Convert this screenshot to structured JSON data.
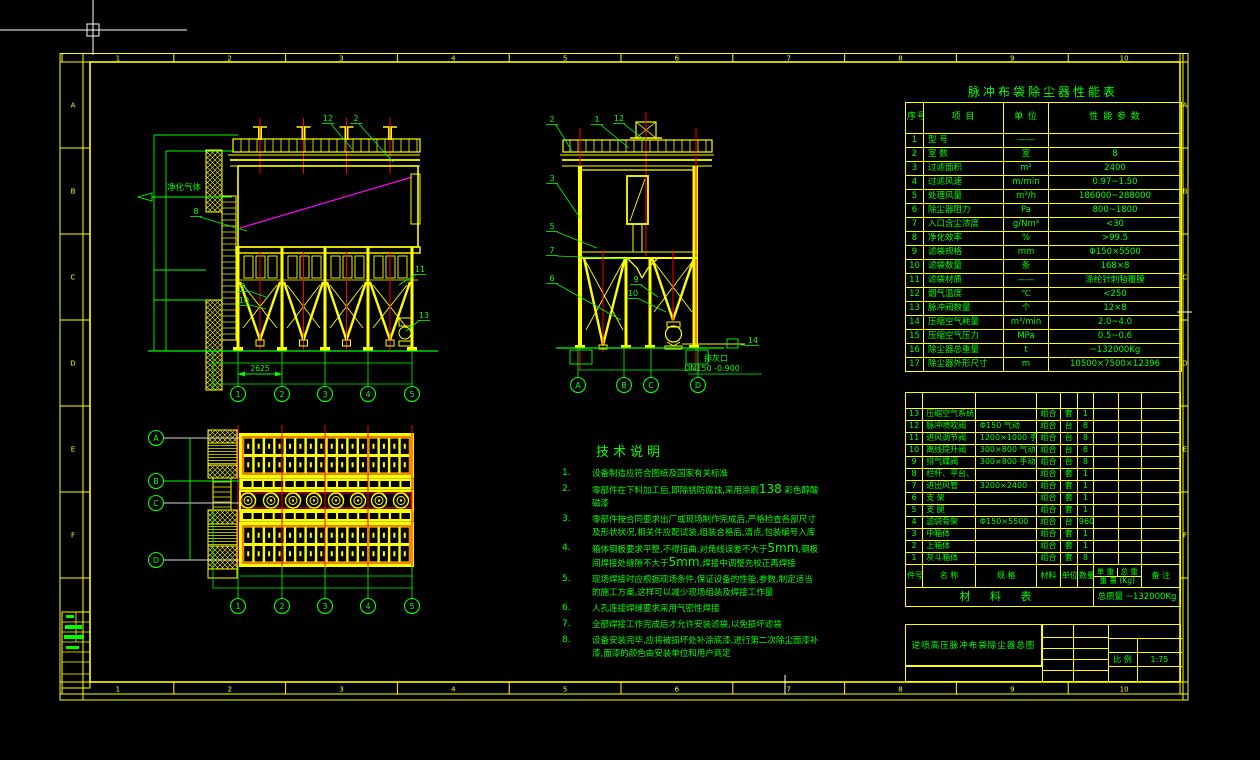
{
  "cursor": {
    "type": "crosshair"
  },
  "sheet": {
    "zone_numbers": [
      "1",
      "2",
      "3",
      "4",
      "5",
      "6",
      "7",
      "8",
      "9",
      "10"
    ],
    "zone_letters": [
      "A",
      "B",
      "C",
      "D",
      "E",
      "F"
    ],
    "colors": {
      "line": "#FFFF00",
      "text": "#00FF00",
      "centerline": "#FF0000",
      "diagonal": "#FF00FF"
    }
  },
  "performance_table": {
    "title": "脉冲布袋除尘器性能表",
    "headers": [
      "序号",
      "项    目",
      "单 位",
      "性 能 参 数"
    ],
    "rows": [
      [
        "1",
        "型  号",
        "——",
        ""
      ],
      [
        "2",
        "室  数",
        "室",
        "8"
      ],
      [
        "3",
        "过滤面积",
        "m²",
        "2400"
      ],
      [
        "4",
        "过滤风速",
        "m/min",
        "0.97~1.50"
      ],
      [
        "5",
        "处理风量",
        "m³/h",
        "186000~288000"
      ],
      [
        "6",
        "除尘器阻力",
        "Pa",
        "800~1800"
      ],
      [
        "7",
        "入口含尘浓度",
        "g/Nm³",
        "<30"
      ],
      [
        "8",
        "净化效率",
        "%",
        ">99.5"
      ],
      [
        "9",
        "滤袋规格",
        "mm",
        "Φ150×5500"
      ],
      [
        "10",
        "滤袋数量",
        "条",
        "168×8"
      ],
      [
        "11",
        "滤袋材质",
        "——",
        "涤纶针刺毡覆膜"
      ],
      [
        "12",
        "烟气温度",
        "℃",
        "<250"
      ],
      [
        "13",
        "脉冲阀数量",
        "个",
        "12×8"
      ],
      [
        "14",
        "压缩空气耗量",
        "m³/min",
        "2.0~4.0"
      ],
      [
        "15",
        "压缩空气压力",
        "MPa",
        "0.5~0.6"
      ],
      [
        "16",
        "除尘器总重量",
        "t",
        "~132000Kg"
      ],
      [
        "17",
        "除尘器外形尺寸",
        "m",
        "10500×7500×12396"
      ]
    ]
  },
  "material_table": {
    "title": "材 料 表",
    "headers": {
      "no": "件号",
      "name": "名    称",
      "spec": "规    格",
      "material": "材料",
      "unit": "单位",
      "qty": "数量",
      "unit_weight": "单 重",
      "total_weight": "总 重",
      "weight_unit": "重 量 (Kg)",
      "remark": "备  注"
    },
    "rows": [
      [
        "13",
        "压缩空气系统",
        "",
        "组合",
        "套",
        "1"
      ],
      [
        "12",
        "脉冲喷吹阀",
        "Φ150  气动",
        "组合",
        "台",
        "8"
      ],
      [
        "11",
        "进风调节阀",
        "1200×1000  手动",
        "组合",
        "台",
        "8"
      ],
      [
        "10",
        "离线提升阀",
        "300×800  气动",
        "组合",
        "台",
        "8"
      ],
      [
        "9",
        "排气蝶阀",
        "300×800  手动",
        "组合",
        "台",
        "8"
      ],
      [
        "8",
        "栏杆、平台、扶梯",
        "",
        "组合",
        "套",
        "1"
      ],
      [
        "7",
        "进出风管",
        "3200×2400",
        "组合",
        "套",
        "1"
      ],
      [
        "6",
        "支  架",
        "",
        "组合",
        "套",
        "1"
      ],
      [
        "5",
        "支  腿",
        "",
        "组合",
        "套",
        "1"
      ],
      [
        "4",
        "滤袋骨架",
        "Φ150×5500",
        "组合",
        "台",
        "960"
      ],
      [
        "3",
        "中箱体",
        "",
        "组合",
        "套",
        "1"
      ],
      [
        "2",
        "上箱体",
        "",
        "组合",
        "套",
        "1"
      ],
      [
        "1",
        "灰斗箱体",
        "",
        "组合",
        "套",
        "8"
      ]
    ],
    "total_label": "总质量",
    "total_value": "~132000Kg"
  },
  "title_block": {
    "drawing_title": "逆喷高压脉冲布袋除尘器总图",
    "scale_label": "比 例",
    "scale_value": "1:75"
  },
  "notes": {
    "title": "技术说明",
    "items": [
      "设备制造应符合图纸及国家有关标准",
      "零部件在下料加工后,即除锈防腐蚀,采用涂刷138 彩色醇酸磁漆",
      "零部件按合同要求出厂或现场制作完成后,严格检查各部尺寸及形状状况,相关件应配试装,组装合格后,清点,包装编号入库",
      "箱体钢板要求平整,不得扭曲,对角线误差不大于5mm,钢板间焊接处缝隙不大于5mm,焊接中调整先校正再焊接",
      "现场焊接时应根据现场条件,保证设备的性能,参数,制定适当的施工方案,这样可以减少现场组装及焊接工作量",
      "人孔连接焊缝要求采用气密性焊接",
      "全部焊接工作完成后才允许安装滤袋,以免损坏滤袋",
      "设备安装完毕,应将被损坏处补涂底漆,进行第二次除尘面漆补漆,面漆的颜色由安装单位和用户商定"
    ]
  },
  "front_view": {
    "inlet_label": "净化气体",
    "dim_text": "2625",
    "part_labels": [
      "12",
      "2",
      "8",
      "9",
      "10",
      "11",
      "13"
    ],
    "axis_bubbles": [
      "1",
      "2",
      "3",
      "4",
      "5"
    ]
  },
  "side_view": {
    "part_labels": [
      "2",
      "1",
      "12",
      "3",
      "5",
      "7",
      "6",
      "9",
      "10",
      "14"
    ],
    "outlet_note_line1": "排灰口",
    "outlet_note_line2": "DN150 -0.900",
    "axis_bubbles": [
      "A",
      "B",
      "C",
      "D"
    ]
  },
  "plan_view": {
    "axis_bubbles_bottom": [
      "1",
      "2",
      "3",
      "4",
      "5"
    ],
    "axis_bubbles_left": [
      "A",
      "B",
      "C",
      "D"
    ]
  }
}
